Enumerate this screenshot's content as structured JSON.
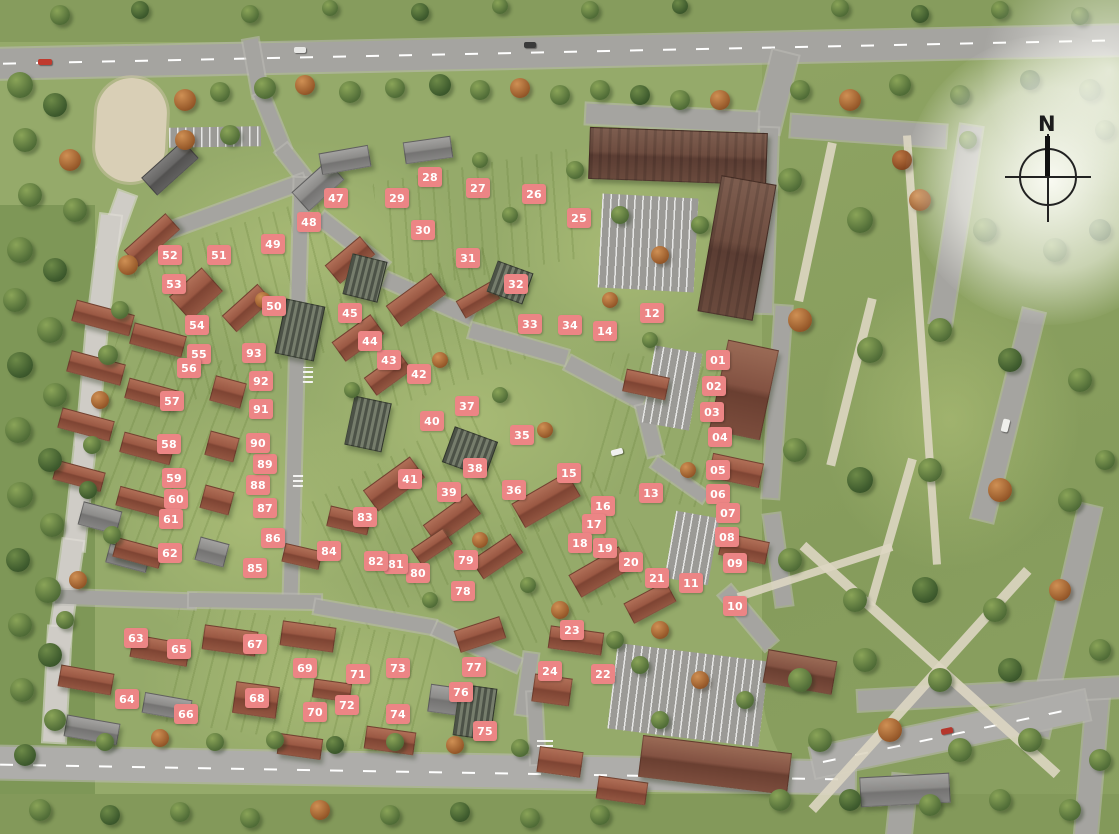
{
  "compass": {
    "label": "N"
  },
  "markers": {
    "color": "#ec8585",
    "text_color": "#ffffff",
    "items": [
      {
        "label": "01",
        "x": 718,
        "y": 360
      },
      {
        "label": "02",
        "x": 714,
        "y": 386
      },
      {
        "label": "03",
        "x": 712,
        "y": 412
      },
      {
        "label": "04",
        "x": 720,
        "y": 437
      },
      {
        "label": "05",
        "x": 718,
        "y": 470
      },
      {
        "label": "06",
        "x": 718,
        "y": 494
      },
      {
        "label": "07",
        "x": 728,
        "y": 513
      },
      {
        "label": "08",
        "x": 727,
        "y": 537
      },
      {
        "label": "09",
        "x": 735,
        "y": 563
      },
      {
        "label": "10",
        "x": 735,
        "y": 606
      },
      {
        "label": "11",
        "x": 691,
        "y": 583
      },
      {
        "label": "12",
        "x": 652,
        "y": 313
      },
      {
        "label": "13",
        "x": 651,
        "y": 493
      },
      {
        "label": "14",
        "x": 605,
        "y": 331
      },
      {
        "label": "15",
        "x": 569,
        "y": 473
      },
      {
        "label": "16",
        "x": 603,
        "y": 506
      },
      {
        "label": "17",
        "x": 594,
        "y": 524
      },
      {
        "label": "18",
        "x": 580,
        "y": 543
      },
      {
        "label": "19",
        "x": 605,
        "y": 548
      },
      {
        "label": "20",
        "x": 631,
        "y": 562
      },
      {
        "label": "21",
        "x": 657,
        "y": 578
      },
      {
        "label": "22",
        "x": 603,
        "y": 674
      },
      {
        "label": "23",
        "x": 572,
        "y": 630
      },
      {
        "label": "24",
        "x": 550,
        "y": 671
      },
      {
        "label": "25",
        "x": 579,
        "y": 218
      },
      {
        "label": "26",
        "x": 534,
        "y": 194
      },
      {
        "label": "27",
        "x": 478,
        "y": 188
      },
      {
        "label": "28",
        "x": 430,
        "y": 177
      },
      {
        "label": "29",
        "x": 397,
        "y": 198
      },
      {
        "label": "30",
        "x": 423,
        "y": 230
      },
      {
        "label": "31",
        "x": 468,
        "y": 258
      },
      {
        "label": "32",
        "x": 516,
        "y": 284
      },
      {
        "label": "33",
        "x": 530,
        "y": 324
      },
      {
        "label": "34",
        "x": 570,
        "y": 325
      },
      {
        "label": "35",
        "x": 522,
        "y": 435
      },
      {
        "label": "36",
        "x": 514,
        "y": 490
      },
      {
        "label": "37",
        "x": 467,
        "y": 406
      },
      {
        "label": "38",
        "x": 475,
        "y": 468
      },
      {
        "label": "39",
        "x": 449,
        "y": 492
      },
      {
        "label": "40",
        "x": 432,
        "y": 421
      },
      {
        "label": "41",
        "x": 410,
        "y": 479
      },
      {
        "label": "42",
        "x": 419,
        "y": 374
      },
      {
        "label": "43",
        "x": 389,
        "y": 360
      },
      {
        "label": "44",
        "x": 370,
        "y": 341
      },
      {
        "label": "45",
        "x": 350,
        "y": 313
      },
      {
        "label": "47",
        "x": 336,
        "y": 198
      },
      {
        "label": "48",
        "x": 309,
        "y": 222
      },
      {
        "label": "49",
        "x": 273,
        "y": 244
      },
      {
        "label": "50",
        "x": 274,
        "y": 306
      },
      {
        "label": "51",
        "x": 219,
        "y": 255
      },
      {
        "label": "52",
        "x": 170,
        "y": 255
      },
      {
        "label": "53",
        "x": 174,
        "y": 284
      },
      {
        "label": "54",
        "x": 197,
        "y": 325
      },
      {
        "label": "55",
        "x": 199,
        "y": 354
      },
      {
        "label": "56",
        "x": 189,
        "y": 368
      },
      {
        "label": "57",
        "x": 172,
        "y": 401
      },
      {
        "label": "58",
        "x": 169,
        "y": 444
      },
      {
        "label": "59",
        "x": 174,
        "y": 478
      },
      {
        "label": "60",
        "x": 176,
        "y": 499
      },
      {
        "label": "61",
        "x": 171,
        "y": 519
      },
      {
        "label": "62",
        "x": 170,
        "y": 553
      },
      {
        "label": "63",
        "x": 136,
        "y": 638
      },
      {
        "label": "64",
        "x": 127,
        "y": 699
      },
      {
        "label": "65",
        "x": 179,
        "y": 649
      },
      {
        "label": "66",
        "x": 186,
        "y": 714
      },
      {
        "label": "67",
        "x": 255,
        "y": 644
      },
      {
        "label": "68",
        "x": 257,
        "y": 698
      },
      {
        "label": "69",
        "x": 305,
        "y": 668
      },
      {
        "label": "70",
        "x": 315,
        "y": 712
      },
      {
        "label": "71",
        "x": 358,
        "y": 674
      },
      {
        "label": "72",
        "x": 347,
        "y": 705
      },
      {
        "label": "73",
        "x": 398,
        "y": 668
      },
      {
        "label": "74",
        "x": 398,
        "y": 714
      },
      {
        "label": "75",
        "x": 485,
        "y": 731
      },
      {
        "label": "76",
        "x": 461,
        "y": 692
      },
      {
        "label": "77",
        "x": 474,
        "y": 667
      },
      {
        "label": "78",
        "x": 463,
        "y": 591
      },
      {
        "label": "79",
        "x": 466,
        "y": 560
      },
      {
        "label": "80",
        "x": 418,
        "y": 573
      },
      {
        "label": "81",
        "x": 396,
        "y": 564
      },
      {
        "label": "82",
        "x": 376,
        "y": 561
      },
      {
        "label": "83",
        "x": 365,
        "y": 517
      },
      {
        "label": "84",
        "x": 329,
        "y": 551
      },
      {
        "label": "85",
        "x": 255,
        "y": 568
      },
      {
        "label": "86",
        "x": 273,
        "y": 538
      },
      {
        "label": "87",
        "x": 265,
        "y": 508
      },
      {
        "label": "88",
        "x": 258,
        "y": 485
      },
      {
        "label": "89",
        "x": 265,
        "y": 464
      },
      {
        "label": "90",
        "x": 258,
        "y": 443
      },
      {
        "label": "91",
        "x": 261,
        "y": 409
      },
      {
        "label": "92",
        "x": 261,
        "y": 381
      },
      {
        "label": "93",
        "x": 254,
        "y": 353
      }
    ]
  }
}
